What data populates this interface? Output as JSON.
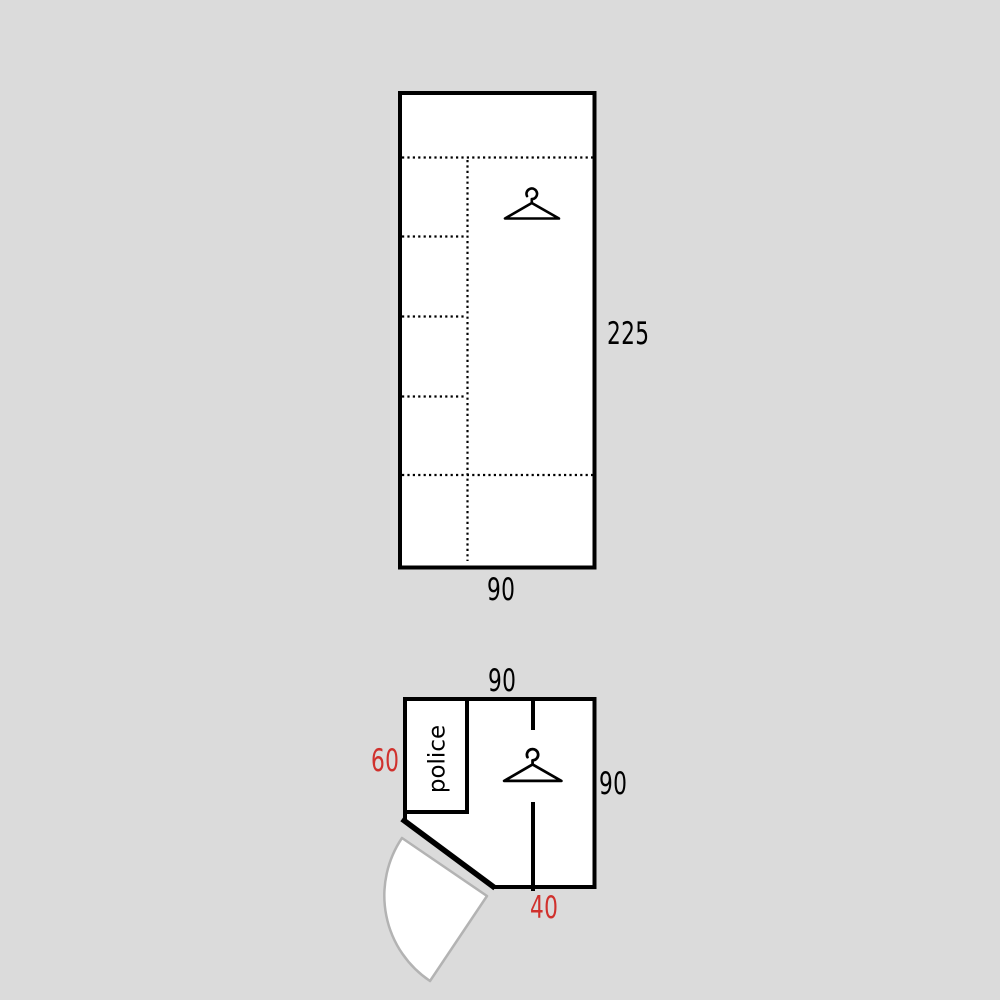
{
  "front_view": {
    "height_label": "225",
    "width_label": "90",
    "icon": "hanger-icon"
  },
  "plan_view": {
    "top_width_label": "90",
    "right_depth_label": "90",
    "left_section_label": "60",
    "bottom_section_label": "40",
    "shelf_text": "police",
    "icon": "hanger-icon"
  },
  "colors": {
    "background": "#dbdbdb",
    "line": "#000000",
    "surface": "#ffffff",
    "highlight_dimension": "#d0312d",
    "door_swing_stroke": "#b3b3b3"
  }
}
